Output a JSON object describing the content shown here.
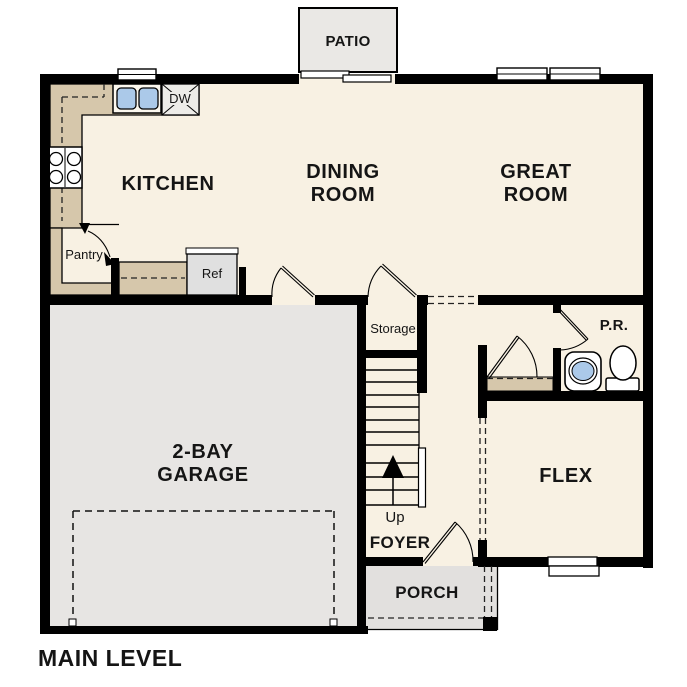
{
  "plan": {
    "level_label": "MAIN LEVEL"
  },
  "rooms": {
    "kitchen": {
      "label": "KITCHEN"
    },
    "dining": {
      "lines": [
        "DINING",
        "ROOM"
      ]
    },
    "great": {
      "lines": [
        "GREAT",
        "ROOM"
      ]
    },
    "garage": {
      "lines": [
        "2-BAY",
        "GARAGE"
      ]
    },
    "flex": {
      "label": "FLEX"
    },
    "foyer": {
      "label": "FOYER"
    },
    "porch": {
      "label": "PORCH"
    },
    "patio": {
      "label": "PATIO"
    },
    "powder_room": {
      "label": "P.R."
    },
    "storage": {
      "label": "Storage"
    },
    "pantry": {
      "label": "Pantry"
    }
  },
  "appliances": {
    "refrigerator": "Ref",
    "dishwasher": "DW"
  },
  "stairs": {
    "direction_label": "Up"
  },
  "colors": {
    "floor": "#f8f1e3",
    "garage_floor": "#e7e5e3",
    "porch_floor": "#e2e0de",
    "patio_floor": "#eae8e5",
    "counter": "#d6c7ab",
    "wall": "#000000",
    "sink_water": "#abc9e9",
    "label_text": "#151515"
  }
}
